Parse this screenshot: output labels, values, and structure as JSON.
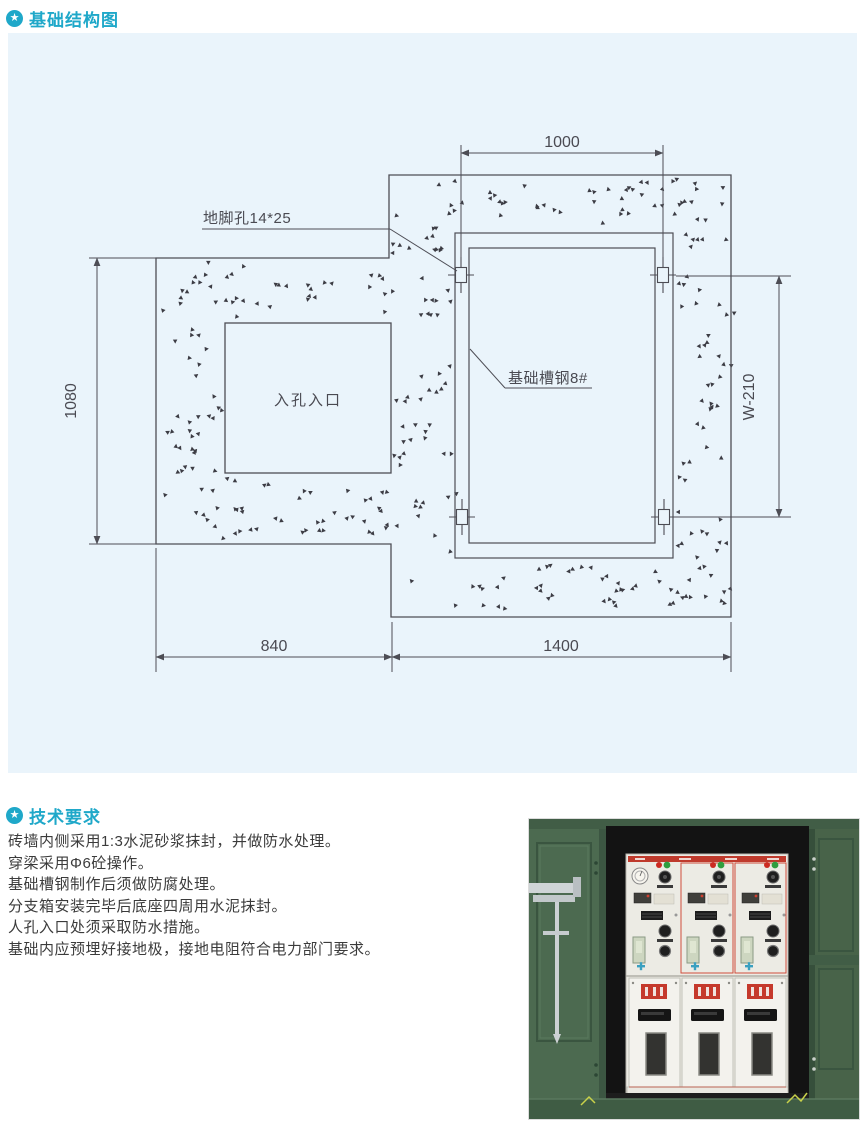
{
  "accent_color": "#1fa8c9",
  "header_foundation": {
    "icon": "star-circle",
    "title": "基础结构图",
    "icon_glyph": "★"
  },
  "header_technical": {
    "icon": "star-circle",
    "title": "技术要求",
    "icon_glyph": "★"
  },
  "requirements": [
    "砖墙内侧采用1:3水泥砂浆抹封，并做防水处理。",
    "穿梁采用Φ6砼操作。",
    "基础槽钢制作后须做防腐处理。",
    "分支箱安装完毕后底座四周用水泥抹封。",
    "人孔入口处须采取防水措施。",
    "基础内应预埋好接地极，接地电阻符合电力部门要求。"
  ],
  "diagram": {
    "background": "#eaf4fb",
    "line_color": "#4d4d55",
    "texture": "concrete-stipple",
    "labels": {
      "anchor_hole": "地脚孔14*25",
      "channel_steel": "基础槽钢8#",
      "manhole_entrance": "入孔入口"
    },
    "dimensions": {
      "top_width": "1000",
      "left_height": "1080",
      "right_height": "W-210",
      "bottom_left_width": "840",
      "bottom_right_width": "1400"
    }
  },
  "photo": {
    "colors": {
      "door_green": "#4c6a50",
      "interior_dark": "#131313",
      "cabinet_body": "#ecebe4",
      "cabinet_red": "#bf3a2c",
      "indicator_red": "#cc2b21",
      "indicator_green": "#2f9e3f",
      "latch_metal": "#cfd4d6"
    }
  }
}
